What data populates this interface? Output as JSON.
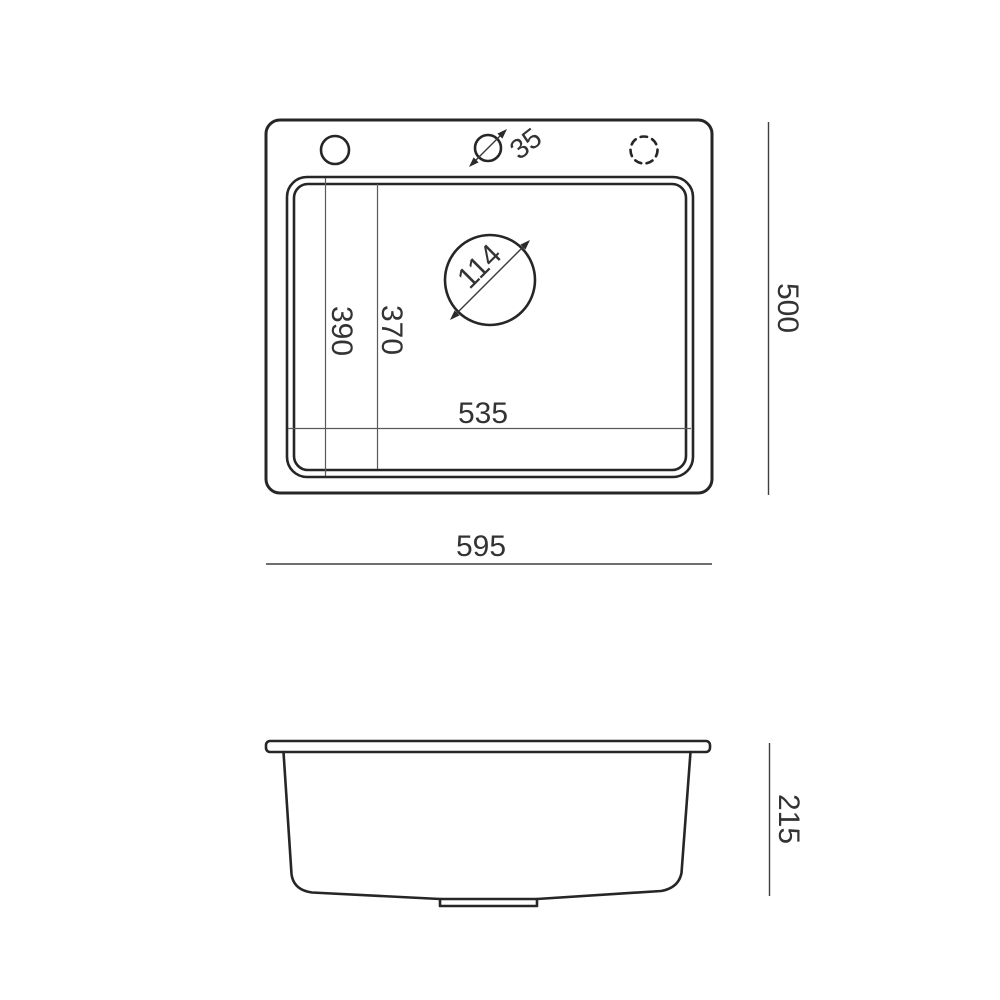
{
  "page": {
    "background": "#ffffff"
  },
  "drawing": {
    "type": "technical-dimension-drawing",
    "subject": "kitchen-sink",
    "colors": {
      "main_stroke": "#262626",
      "thin_line": "#5a5a5a",
      "text": "#333333",
      "background": "#ffffff"
    },
    "views": {
      "top_view": "plan view of sink with mounting holes, faucet hole and drain",
      "side_view": "front elevation of sink bowl with drain fitting"
    },
    "dimensions": {
      "faucet_hole_diameter": "35",
      "drain_hole_diameter": "114",
      "inner_length_back": "390",
      "inner_length_front": "370",
      "inner_width": "535",
      "overall_width": "595",
      "overall_depth": "500",
      "overall_height": "215"
    }
  }
}
